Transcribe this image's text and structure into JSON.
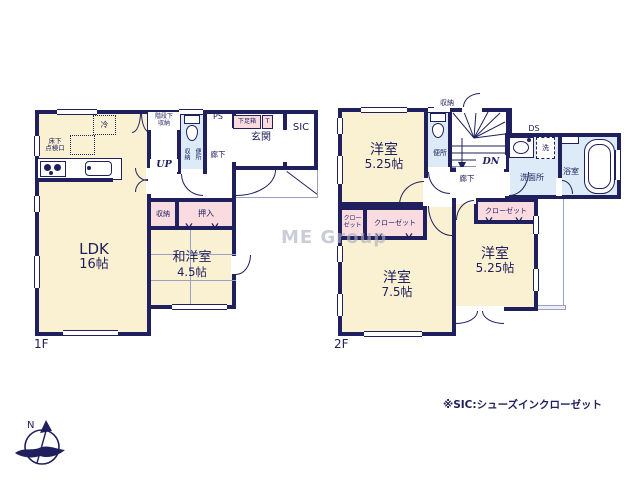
{
  "floor1": {
    "label": "1F",
    "ldk": {
      "name": "LDK",
      "size": "16帖"
    },
    "washitsu": {
      "name": "和洋室",
      "size": "4.5帖"
    },
    "genkan": "玄関",
    "sic": "SIC",
    "hall": "廊下",
    "ps": "PS",
    "shoe_box": "下足箱",
    "shoe_t": "T",
    "under_stair_storage": "階段下\n収納",
    "up": "UP",
    "toilet": "便所",
    "toilet_storage": "収納",
    "storage": "収納",
    "oshiire": "押入",
    "fridge": "冷",
    "floor_hatch": "床下\n点検口"
  },
  "floor2": {
    "label": "2F",
    "bedroom_nw": {
      "name": "洋室",
      "size": "5.25帖"
    },
    "bedroom_sw": {
      "name": "洋室",
      "size": "7.5帖"
    },
    "bedroom_se": {
      "name": "洋室",
      "size": "5.25帖"
    },
    "toilet": "便所",
    "hall": "廊下",
    "storage": "収納",
    "dn": "DN",
    "ds": "DS",
    "washer": "洗",
    "washroom": "洗面所",
    "bathroom": "浴室",
    "closet_west": "クロー\nゼット",
    "closet_mid": "クローゼット",
    "closet_se": "クローゼット"
  },
  "annotations": {
    "sic_note": "※SIC:シューズインクローゼット",
    "watermark": "ME Group",
    "compass_north": "N"
  },
  "colors": {
    "wall": "#20205e",
    "room_cream": "#faf1d2",
    "wet_blue": "#dcebf7",
    "closet_pink": "#fadce0"
  }
}
